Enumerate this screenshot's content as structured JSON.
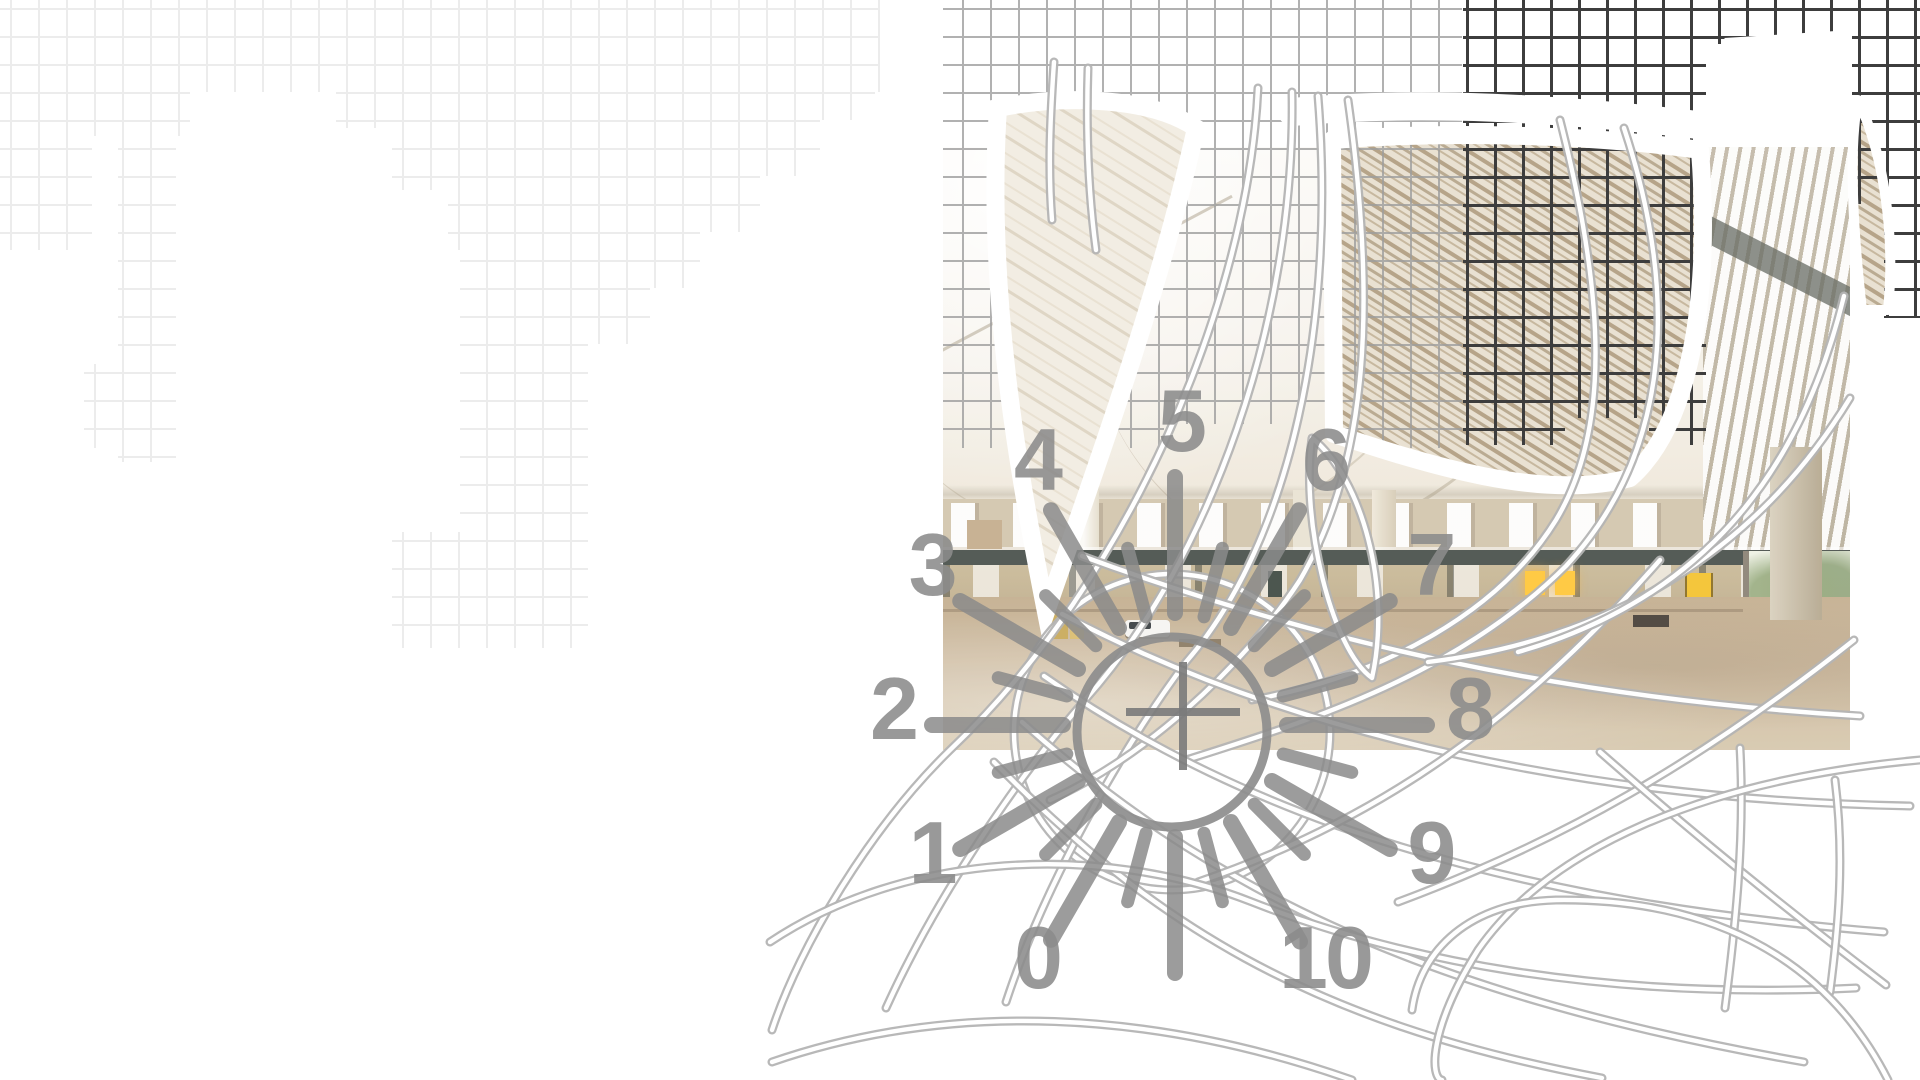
{
  "title": "industrial hall collage with numeric gauge",
  "gauge": {
    "numbers": [
      {
        "label": "0",
        "angle": 240
      },
      {
        "label": "1",
        "angle": 210
      },
      {
        "label": "2",
        "angle": 180
      },
      {
        "label": "3",
        "angle": 150
      },
      {
        "label": "4",
        "angle": 120
      },
      {
        "label": "5",
        "angle": 90
      },
      {
        "label": "6",
        "angle": 60
      },
      {
        "label": "7",
        "angle": 30
      },
      {
        "label": "8",
        "angle": 0
      },
      {
        "label": "9",
        "angle": -30
      },
      {
        "label": "10",
        "angle": -60
      }
    ],
    "numbers_cx": 1181,
    "numbers_cy": 711,
    "numbers_r": 288,
    "ticks": {
      "cx": 1175,
      "cy": 725,
      "step": 15,
      "long_every": 30,
      "r_inner": 112,
      "r_outer_long": 248,
      "r_outer_short": 183,
      "width_long": 16,
      "width_short": 13,
      "override_outer": {
        "0": 252,
        "180": 243,
        "300": 250
      }
    },
    "circle": {
      "cx": 1172,
      "cy": 732,
      "r": 95,
      "stroke_width": 9
    },
    "ring": {
      "cx": 1172,
      "cy": 732,
      "r": 158
    },
    "crosshair": {
      "cx": 1183,
      "cy": 712,
      "arm_left": 57,
      "arm_right": 57,
      "arm_up": 50,
      "arm_down": 58,
      "stroke_width": 8
    }
  },
  "colors": {
    "background": "#ffffff",
    "grid_light": "#ececec",
    "grid_medium": "#9e9e9e",
    "grid_dark": "#3d3d3d",
    "gauge_gray": "#8c8c8c",
    "tick_gray": "#8b8b8b",
    "crosshair_gray": "#7b7b7b",
    "tube_gray": "#b4b4b4",
    "beam_dark": "#49504b",
    "floor_sand": "#ccb99d",
    "taupe_streak": "#b6a489",
    "door_yellow": "#f4c22e",
    "window_glow": "#ffc637",
    "greenery": "#94a87a"
  }
}
